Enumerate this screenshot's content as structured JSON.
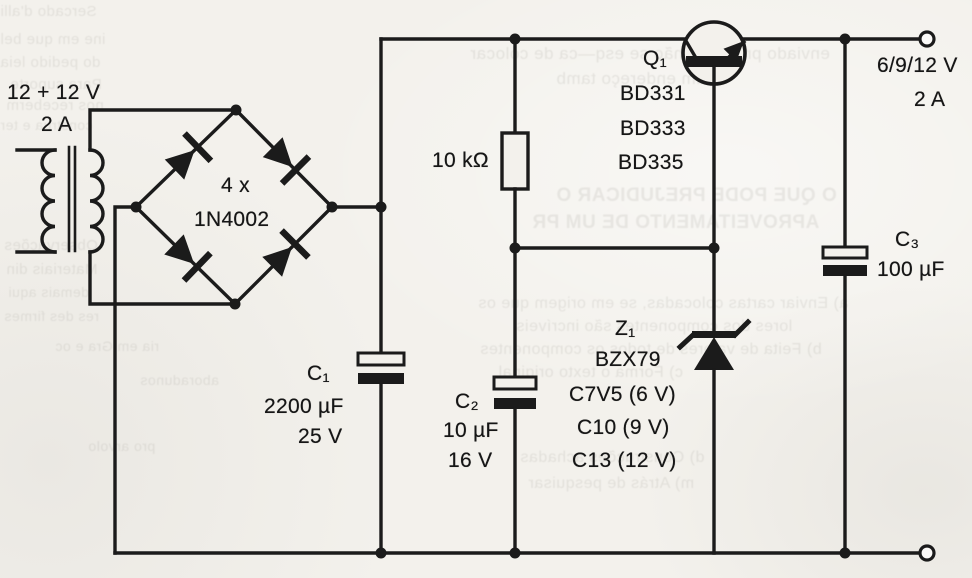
{
  "figure": {
    "type": "circuit-schematic",
    "description": "Regulated power supply schematic, scanned book page"
  },
  "transformer": {
    "rating": "12 + 12 V",
    "current": "2 A"
  },
  "bridge": {
    "quantity": "4 x",
    "part": "1N4002"
  },
  "resistor": {
    "value": "10 kΩ"
  },
  "transistor": {
    "ref": "Q₁",
    "options": [
      "BD331",
      "BD333",
      "BD335"
    ]
  },
  "zener": {
    "ref": "Z₁",
    "family": "BZX79",
    "options": [
      "C7V5 (6 V)",
      "C10 (9 V)",
      "C13 (12 V)"
    ]
  },
  "capacitors": {
    "c1": {
      "ref": "C₁",
      "value": "2200 µF",
      "voltage": "25 V"
    },
    "c2": {
      "ref": "C₂",
      "value": "10 µF",
      "voltage": "16 V"
    },
    "c3": {
      "ref": "C₃",
      "value": "100 µF"
    }
  },
  "output": {
    "voltage": "6/9/12 V",
    "current": "2 A"
  },
  "colors": {
    "ink": "#1b1b1b",
    "paper": "#f3f1ec",
    "bleed": "#8f8c84"
  },
  "artifacts": [
    {
      "text": "Sercado d'alli"
    },
    {
      "text": "ine em que bel"
    },
    {
      "text": "do pedido leia"
    },
    {
      "text": "Para suporte"
    },
    {
      "text": "nos receberm"
    },
    {
      "text": "construa e ter"
    },
    {
      "text": "Observações"
    },
    {
      "text": "Materiais din"
    },
    {
      "text": "demais aqui"
    },
    {
      "text": "res des firmes"
    },
    {
      "text": "enviado principal, não se esq—ca de colocar"
    },
    {
      "text": "um endereço tamb"
    },
    {
      "text": "O QUE PODE PREJUDICAR O"
    },
    {
      "text": "APROVEITAMENTO DE UM PR"
    },
    {
      "text": "a) Enviar cartas colocadas, se em origem que os"
    },
    {
      "text": "lores dos componentes são incríveis"
    },
    {
      "text": "b) Feita de valores de todos os componentes"
    },
    {
      "text": "c) Forma o texto original"
    },
    {
      "text": "d) Construções achadas"
    },
    {
      "text": "m) Atrás de pesquisar"
    },
    {
      "text": "ria em Gra e oc"
    },
    {
      "text": "aboradunos"
    },
    {
      "text": "pro arvolo"
    }
  ]
}
